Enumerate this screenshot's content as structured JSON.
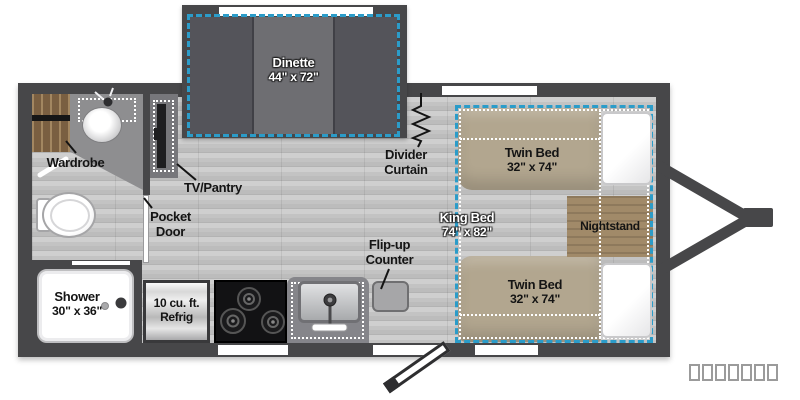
{
  "labels": {
    "dinette": {
      "name": "Dinette",
      "dims": "44\" x 72\""
    },
    "divider_curtain": {
      "line1": "Divider",
      "line2": "Curtain"
    },
    "twin_bed_top": {
      "name": "Twin Bed",
      "dims": "32\" x 74\""
    },
    "twin_bed_bottom": {
      "name": "Twin Bed",
      "dims": "32\" x 74\""
    },
    "king_bed": {
      "name": "King Bed",
      "dims": "74\" x 82\""
    },
    "nightstand": {
      "name": "Nightstand"
    },
    "wardrobe": {
      "name": "Wardrobe"
    },
    "tv_pantry": {
      "name": "TV/Pantry"
    },
    "pocket_door": {
      "line1": "Pocket",
      "line2": "Door"
    },
    "flip_up_counter": {
      "line1": "Flip-up",
      "line2": "Counter"
    },
    "shower": {
      "name": "Shower",
      "dims": "30\" x 36\""
    },
    "refrigerator": {
      "line1": "10 cu. ft.",
      "line2": "Refrig"
    }
  },
  "colors": {
    "wall": "#474749",
    "dash_blue": "#2b9cc9",
    "bed_tan": "#b2a68f",
    "nightstand_wood": "#a18a69",
    "wardrobe_wood": "#7a5f41"
  }
}
